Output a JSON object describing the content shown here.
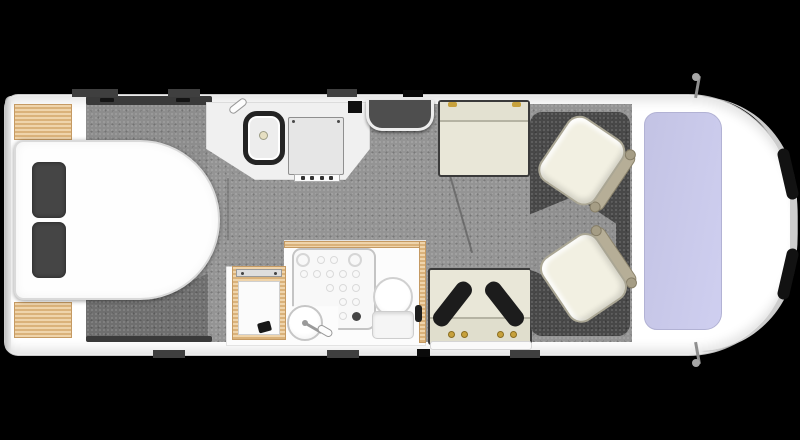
{
  "floorplan": {
    "subject": "motorhome-floorplan",
    "view": "top-down",
    "zones": [
      {
        "name": "rear-bedroom",
        "features": [
          "island-bed",
          "pillow-left",
          "pillow-right",
          "wardrobe-top",
          "wardrobe-bottom",
          "overhead-locker-rail"
        ]
      },
      {
        "name": "kitchen",
        "features": [
          "worktop",
          "sink-with-tap",
          "hob",
          "control-knobs"
        ]
      },
      {
        "name": "entrance",
        "features": [
          "entry-door-step",
          "control-panel"
        ]
      },
      {
        "name": "washroom",
        "features": [
          "shower-tray",
          "washbasin-with-tap",
          "toilet",
          "storage-cabinet"
        ]
      },
      {
        "name": "lounge",
        "features": [
          "bench-seat-front",
          "bench-seat-rear",
          "headrests",
          "seat-belt-anchors",
          "side-table-rail"
        ]
      },
      {
        "name": "cab",
        "features": [
          "swivel-seat-upper",
          "swivel-seat-lower",
          "cab-platform",
          "windscreen",
          "wing-mirror-top",
          "wing-mirror-bottom",
          "headlight-upper",
          "headlight-lower",
          "front-bumper"
        ]
      }
    ]
  },
  "colors": {
    "background": "#000000",
    "body": "#ffffff",
    "floor": "#949494",
    "floor_step": "#6f6f6f",
    "platform": "#484848",
    "wood": "#eac58f",
    "bed": "#fefefe",
    "pillow": "#454545",
    "bench": "#e9e7d8",
    "bench_edge": "#3a3a3a",
    "headrest": "#1c1c1c",
    "belt_anchor": "#c7a13c",
    "seat": "#f2f0e2",
    "seat_back": "#b6ae97",
    "windshield": "#c8c8e9",
    "hob": "#e6e6e6",
    "chrome": "#cdcdcd",
    "headlight": "#121212"
  }
}
